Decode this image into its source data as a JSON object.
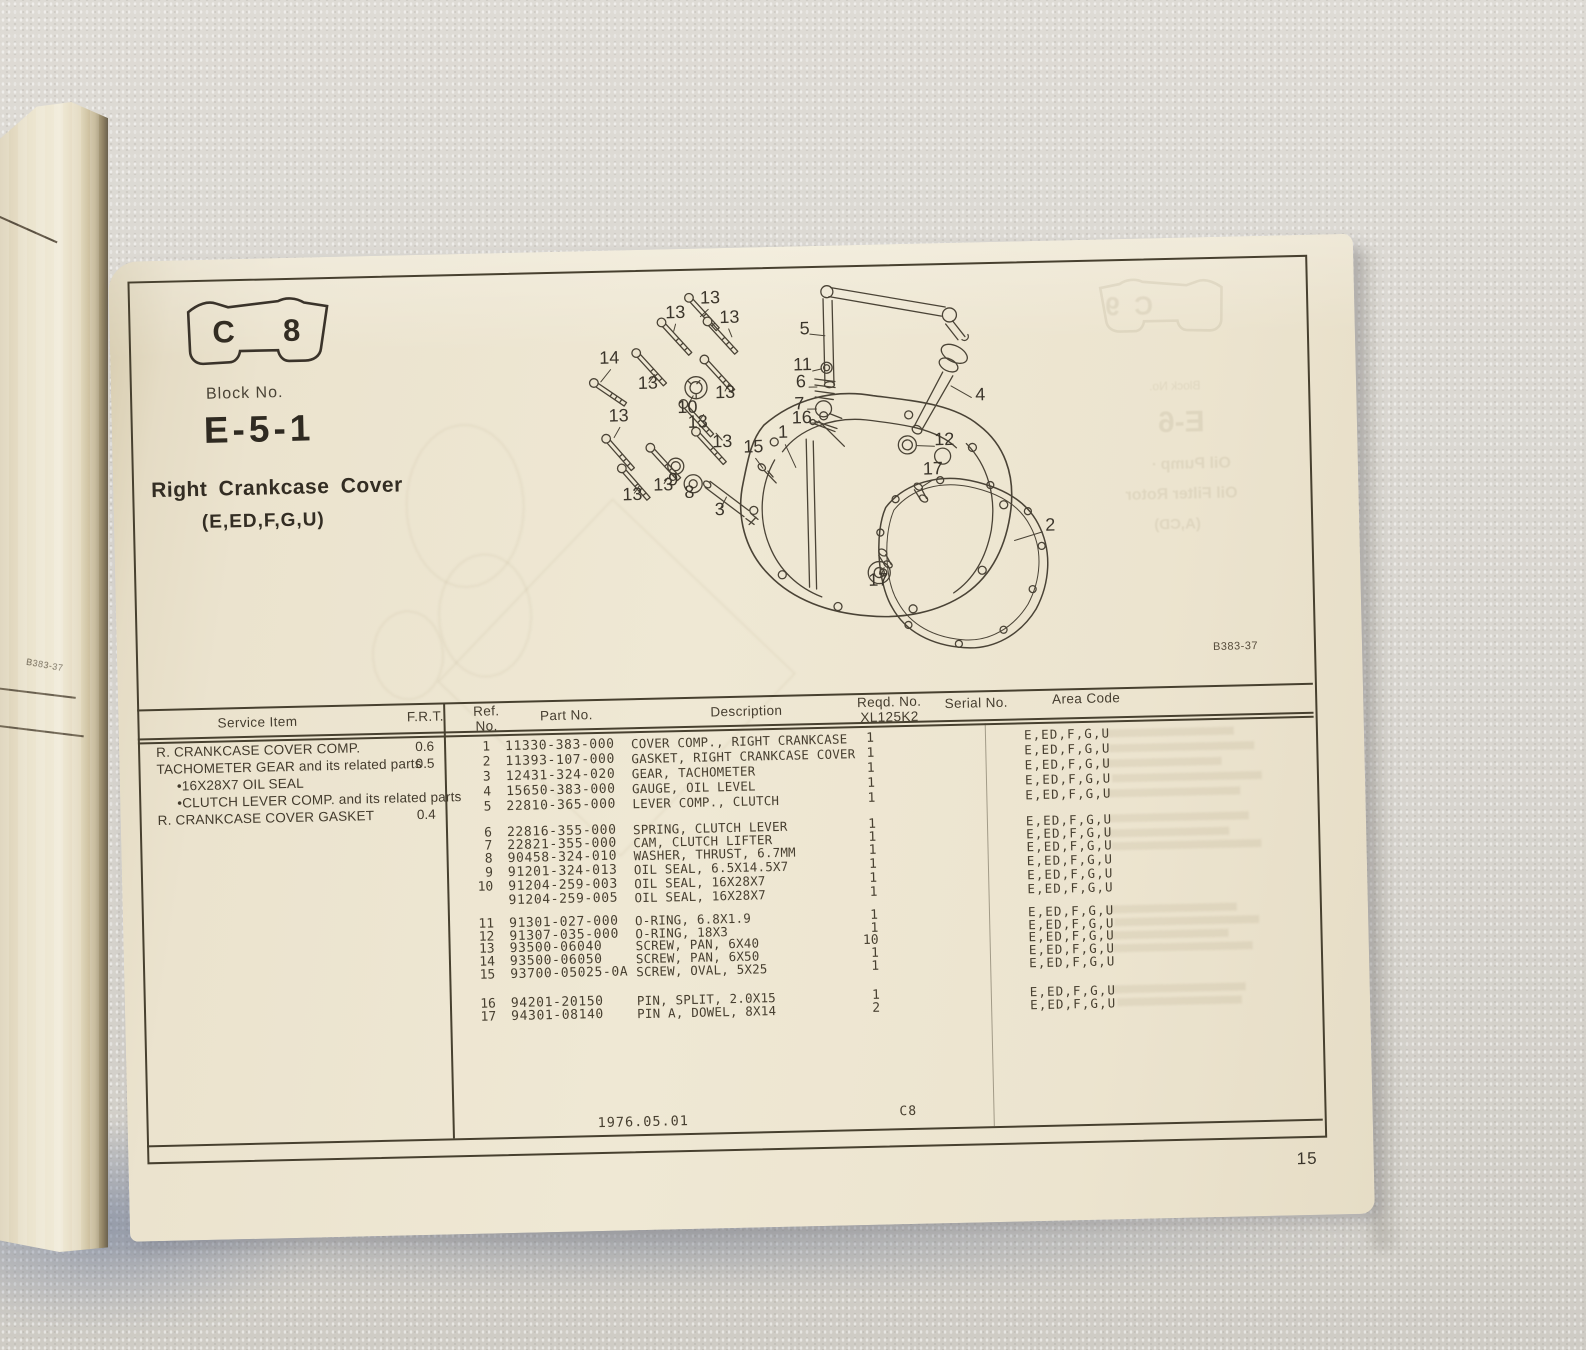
{
  "page": {
    "tab_left": "C",
    "tab_right": "8",
    "block_no_label": "Block No.",
    "block_no": "E-5-1",
    "title": "Right Crankcase Cover",
    "subtitle": "(E,ED,F,G,U)",
    "diagram_ref": "B383-37",
    "page_number": "15",
    "footer_date": "1976.05.01",
    "footer_code": "C8"
  },
  "spine_fragment": {
    "diagram_ref": "B383-37"
  },
  "ghost_next_page": {
    "tab_left": "C",
    "tab_right": "9",
    "block_label": "Block No.",
    "block_no": "E-6",
    "line1": "Oil Pump ·",
    "line2": "Oil Filter Rotor",
    "line3": "(A,CD)"
  },
  "service_table": {
    "header_item": "Service Item",
    "header_frt": "F.R.T.",
    "rows": [
      {
        "item": "R. CRANKCASE COVER COMP.",
        "frt": "0.6",
        "indent": false
      },
      {
        "item": "TACHOMETER GEAR and its related parts",
        "frt": "0.5",
        "indent": false
      },
      {
        "item": "•16X28X7 OIL SEAL",
        "frt": "",
        "indent": true
      },
      {
        "item": "•CLUTCH LEVER COMP. and its related parts",
        "frt": "",
        "indent": true
      },
      {
        "item": "R. CRANKCASE COVER GASKET",
        "frt": "0.4",
        "indent": false
      }
    ]
  },
  "parts_table": {
    "header_ref_1": "Ref.",
    "header_ref_2": "No.",
    "header_part": "Part No.",
    "header_desc": "Description",
    "header_reqd_1": "Reqd. No.",
    "header_reqd_2": "XL125K2",
    "header_serial": "Serial No.",
    "header_area": "Area Code",
    "groups": [
      [
        {
          "ref": "1",
          "part": "11330-383-000",
          "desc": "COVER COMP., RIGHT CRANKCASE",
          "qty": "1",
          "area": "E,ED,F,G,U"
        },
        {
          "ref": "2",
          "part": "11393-107-000",
          "desc": "GASKET, RIGHT CRANKCASE COVER",
          "qty": "1",
          "area": "E,ED,F,G,U"
        },
        {
          "ref": "3",
          "part": "12431-324-020",
          "desc": "GEAR, TACHOMETER",
          "qty": "1",
          "area": "E,ED,F,G,U"
        },
        {
          "ref": "4",
          "part": "15650-383-000",
          "desc": "GAUGE, OIL LEVEL",
          "qty": "1",
          "area": "E,ED,F,G,U"
        },
        {
          "ref": "5",
          "part": "22810-365-000",
          "desc": "LEVER COMP., CLUTCH",
          "qty": "1",
          "area": "E,ED,F,G,U"
        }
      ],
      [
        {
          "ref": "6",
          "part": "22816-355-000",
          "desc": "SPRING, CLUTCH LEVER",
          "qty": "1",
          "area": "E,ED,F,G,U"
        },
        {
          "ref": "7",
          "part": "22821-355-000",
          "desc": "CAM, CLUTCH LIFTER",
          "qty": "1",
          "area": "E,ED,F,G,U"
        },
        {
          "ref": "8",
          "part": "90458-324-010",
          "desc": "WASHER, THRUST, 6.7MM",
          "qty": "1",
          "area": "E,ED,F,G,U"
        },
        {
          "ref": "9",
          "part": "91201-324-013",
          "desc": "OIL SEAL, 6.5X14.5X7",
          "qty": "1",
          "area": "E,ED,F,G,U"
        },
        {
          "ref": "10",
          "part": "91204-259-003",
          "desc": "OIL SEAL, 16X28X7",
          "qty": "1",
          "area": "E,ED,F,G,U"
        },
        {
          "ref": "",
          "part": "91204-259-005",
          "desc": "OIL SEAL, 16X28X7",
          "qty": "1",
          "area": "E,ED,F,G,U"
        }
      ],
      [
        {
          "ref": "11",
          "part": "91301-027-000",
          "desc": "O-RING, 6.8X1.9",
          "qty": "1",
          "area": "E,ED,F,G,U"
        },
        {
          "ref": "12",
          "part": "91307-035-000",
          "desc": "O-RING, 18X3",
          "qty": "1",
          "area": "E,ED,F,G,U"
        },
        {
          "ref": "13",
          "part": "93500-06040",
          "desc": "SCREW, PAN, 6X40",
          "qty": "10",
          "area": "E,ED,F,G,U"
        },
        {
          "ref": "14",
          "part": "93500-06050",
          "desc": "SCREW, PAN, 6X50",
          "qty": "1",
          "area": "E,ED,F,G,U"
        },
        {
          "ref": "15",
          "part": "93700-05025-0A",
          "desc": "SCREW, OVAL, 5X25",
          "qty": "1",
          "area": "E,ED,F,G,U"
        }
      ],
      [
        {
          "ref": "16",
          "part": "94201-20150",
          "desc": "PIN, SPLIT, 2.0X15",
          "qty": "1",
          "area": "E,ED,F,G,U"
        },
        {
          "ref": "17",
          "part": "94301-08140",
          "desc": "PIN A, DOWEL, 8X14",
          "qty": "2",
          "area": "E,ED,F,G,U"
        }
      ]
    ]
  },
  "diagram": {
    "callouts": [
      {
        "n": "13",
        "x": 709,
        "y": 312
      },
      {
        "n": "13",
        "x": 674,
        "y": 326
      },
      {
        "n": "13",
        "x": 728,
        "y": 332
      },
      {
        "n": "13",
        "x": 645,
        "y": 396
      },
      {
        "n": "13",
        "x": 722,
        "y": 407
      },
      {
        "n": "13",
        "x": 615,
        "y": 428
      },
      {
        "n": "13",
        "x": 694,
        "y": 436
      },
      {
        "n": "13",
        "x": 718,
        "y": 456
      },
      {
        "n": "13",
        "x": 658,
        "y": 498
      },
      {
        "n": "13",
        "x": 627,
        "y": 507
      },
      {
        "n": "14",
        "x": 607,
        "y": 370
      },
      {
        "n": "10",
        "x": 684,
        "y": 421
      },
      {
        "n": "15",
        "x": 749,
        "y": 462
      },
      {
        "n": "1",
        "x": 779,
        "y": 448
      },
      {
        "n": "9",
        "x": 668,
        "y": 493
      },
      {
        "n": "8",
        "x": 684,
        "y": 506
      },
      {
        "n": "3",
        "x": 714,
        "y": 524
      },
      {
        "n": "5",
        "x": 803,
        "y": 345
      },
      {
        "n": "11",
        "x": 800,
        "y": 381
      },
      {
        "n": "6",
        "x": 798,
        "y": 398
      },
      {
        "n": "7",
        "x": 796,
        "y": 420
      },
      {
        "n": "16",
        "x": 798,
        "y": 434
      },
      {
        "n": "4",
        "x": 977,
        "y": 415
      },
      {
        "n": "12",
        "x": 940,
        "y": 459
      },
      {
        "n": "17",
        "x": 928,
        "y": 488
      },
      {
        "n": "17",
        "x": 871,
        "y": 598
      },
      {
        "n": "2",
        "x": 1044,
        "y": 547
      }
    ]
  }
}
